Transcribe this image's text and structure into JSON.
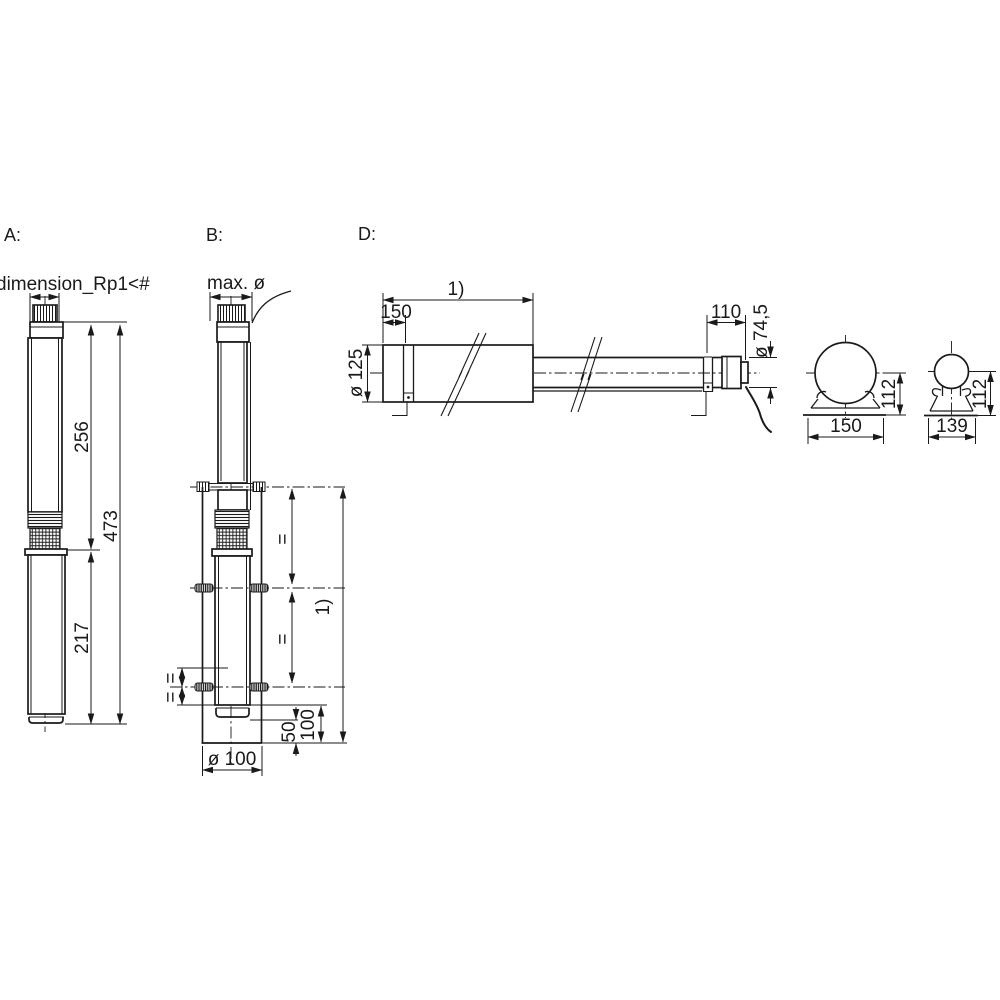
{
  "drawing": {
    "view_a": {
      "label": "A:",
      "dim_port": "dimension_Rp1<#",
      "dim_upper": "256",
      "dim_total": "473",
      "dim_motor": "217"
    },
    "view_b": {
      "label": "B:",
      "dim_max_dia": "max. ø",
      "dim_equal": "=",
      "dim_overall": "1)",
      "dim_clearance_100": "100",
      "dim_clearance_50": "50",
      "dim_casing_dia": "ø 100"
    },
    "view_d": {
      "label": "D:",
      "dim_overall": "1)",
      "dim_cable_offset": "150",
      "dim_end_length": "110",
      "dim_dia_large": "ø 125",
      "dim_dia_small": "ø 74,5",
      "end_view_large": {
        "dim_width": "150",
        "dim_height": "112"
      },
      "end_view_small": {
        "dim_width": "139",
        "dim_height": "112"
      }
    },
    "colors": {
      "ink": "#1a1a1a",
      "paper": "#ffffff"
    }
  }
}
